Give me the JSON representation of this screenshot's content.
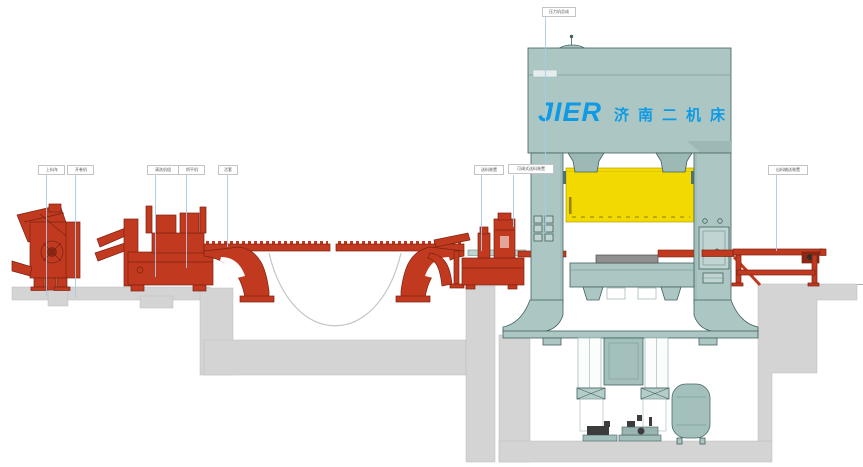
{
  "diagram": {
    "brand": {
      "latin": "JIER",
      "chinese": "济南二机床"
    },
    "callouts": [
      {
        "text": "上料车"
      },
      {
        "text": "开卷机"
      },
      {
        "text": "清洗机组"
      },
      {
        "text": "矫平机"
      },
      {
        "text": "活套"
      },
      {
        "text": "送料装置"
      },
      {
        "text": "可调式送料装置"
      },
      {
        "text": "压力机总成"
      },
      {
        "text": "出料输送装置"
      }
    ],
    "colors": {
      "machine_red": "#c13a1f",
      "machine_red_dark": "#7c2110",
      "press_teal": "#acc7c3",
      "press_teal_dark": "#42605d",
      "slide_yellow": "#f2d900",
      "logo_blue": "#0e9ae4",
      "concrete_gray": "#d4d4d4",
      "leader_blue": "#a6cbe6"
    }
  }
}
